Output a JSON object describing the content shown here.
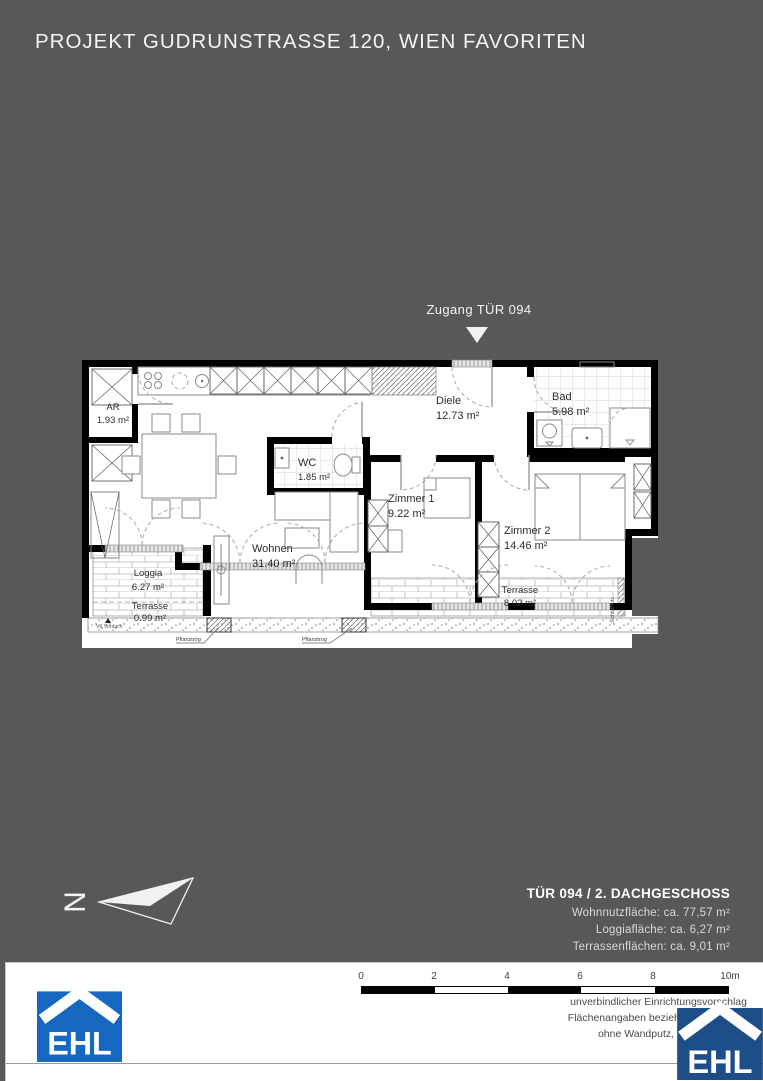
{
  "page": {
    "title": "PROJEKT GUDRUNSTRASSE 120, WIEN FAVORITEN"
  },
  "plan": {
    "entry_label": "Zugang TÜR 094",
    "rooms": [
      {
        "name": "AR",
        "area": "1.93 m²"
      },
      {
        "name": "WC",
        "area": "1.85 m²"
      },
      {
        "name": "Diele",
        "area": "12.73 m²"
      },
      {
        "name": "Bad",
        "area": "5.98 m²"
      },
      {
        "name": "Zimmer 1",
        "area": "9.22 m²"
      },
      {
        "name": "Zimmer 2",
        "area": "14.46 m²"
      },
      {
        "name": "Wohnen",
        "area": "31.40 m²"
      },
      {
        "name": "Loggia",
        "area": "6.27 m²"
      },
      {
        "name": "Terrasse",
        "area": "0.99 m²"
      },
      {
        "name": "Terrasse",
        "area": "8.02 m²"
      }
    ],
    "annotations": {
      "sichtschutz": "Sichtschutz",
      "pflanztrog_left": "Pflanztrog",
      "pflanztrog_right": "Pflanztrog",
      "vk_vordach": "VK Vordach",
      "north_letter": "N"
    }
  },
  "info": {
    "title": "TÜR 094 / 2. DACHGESCHOSS",
    "lines": [
      "Wohnnutzfläche: ca. 77,57 m²",
      "Loggiafläche: ca. 6,27 m²",
      "Terrassenflächen: ca. 9,01 m²"
    ]
  },
  "footer": {
    "scale_ticks": [
      "0",
      "2",
      "4",
      "6",
      "8",
      "10m"
    ],
    "disclaimer": [
      "unverbindlicher Einrichtungsvorschlag",
      "Flächenangaben beziehen sich auf Ro",
      "ohne Wandputz, Verfliesung, Sc"
    ],
    "logo_text": "EHL"
  },
  "colors": {
    "background": "#58585a",
    "ehl_blue": "#1567c0",
    "ehl_blue_dark": "#1d4e87",
    "wall": "#000000"
  }
}
